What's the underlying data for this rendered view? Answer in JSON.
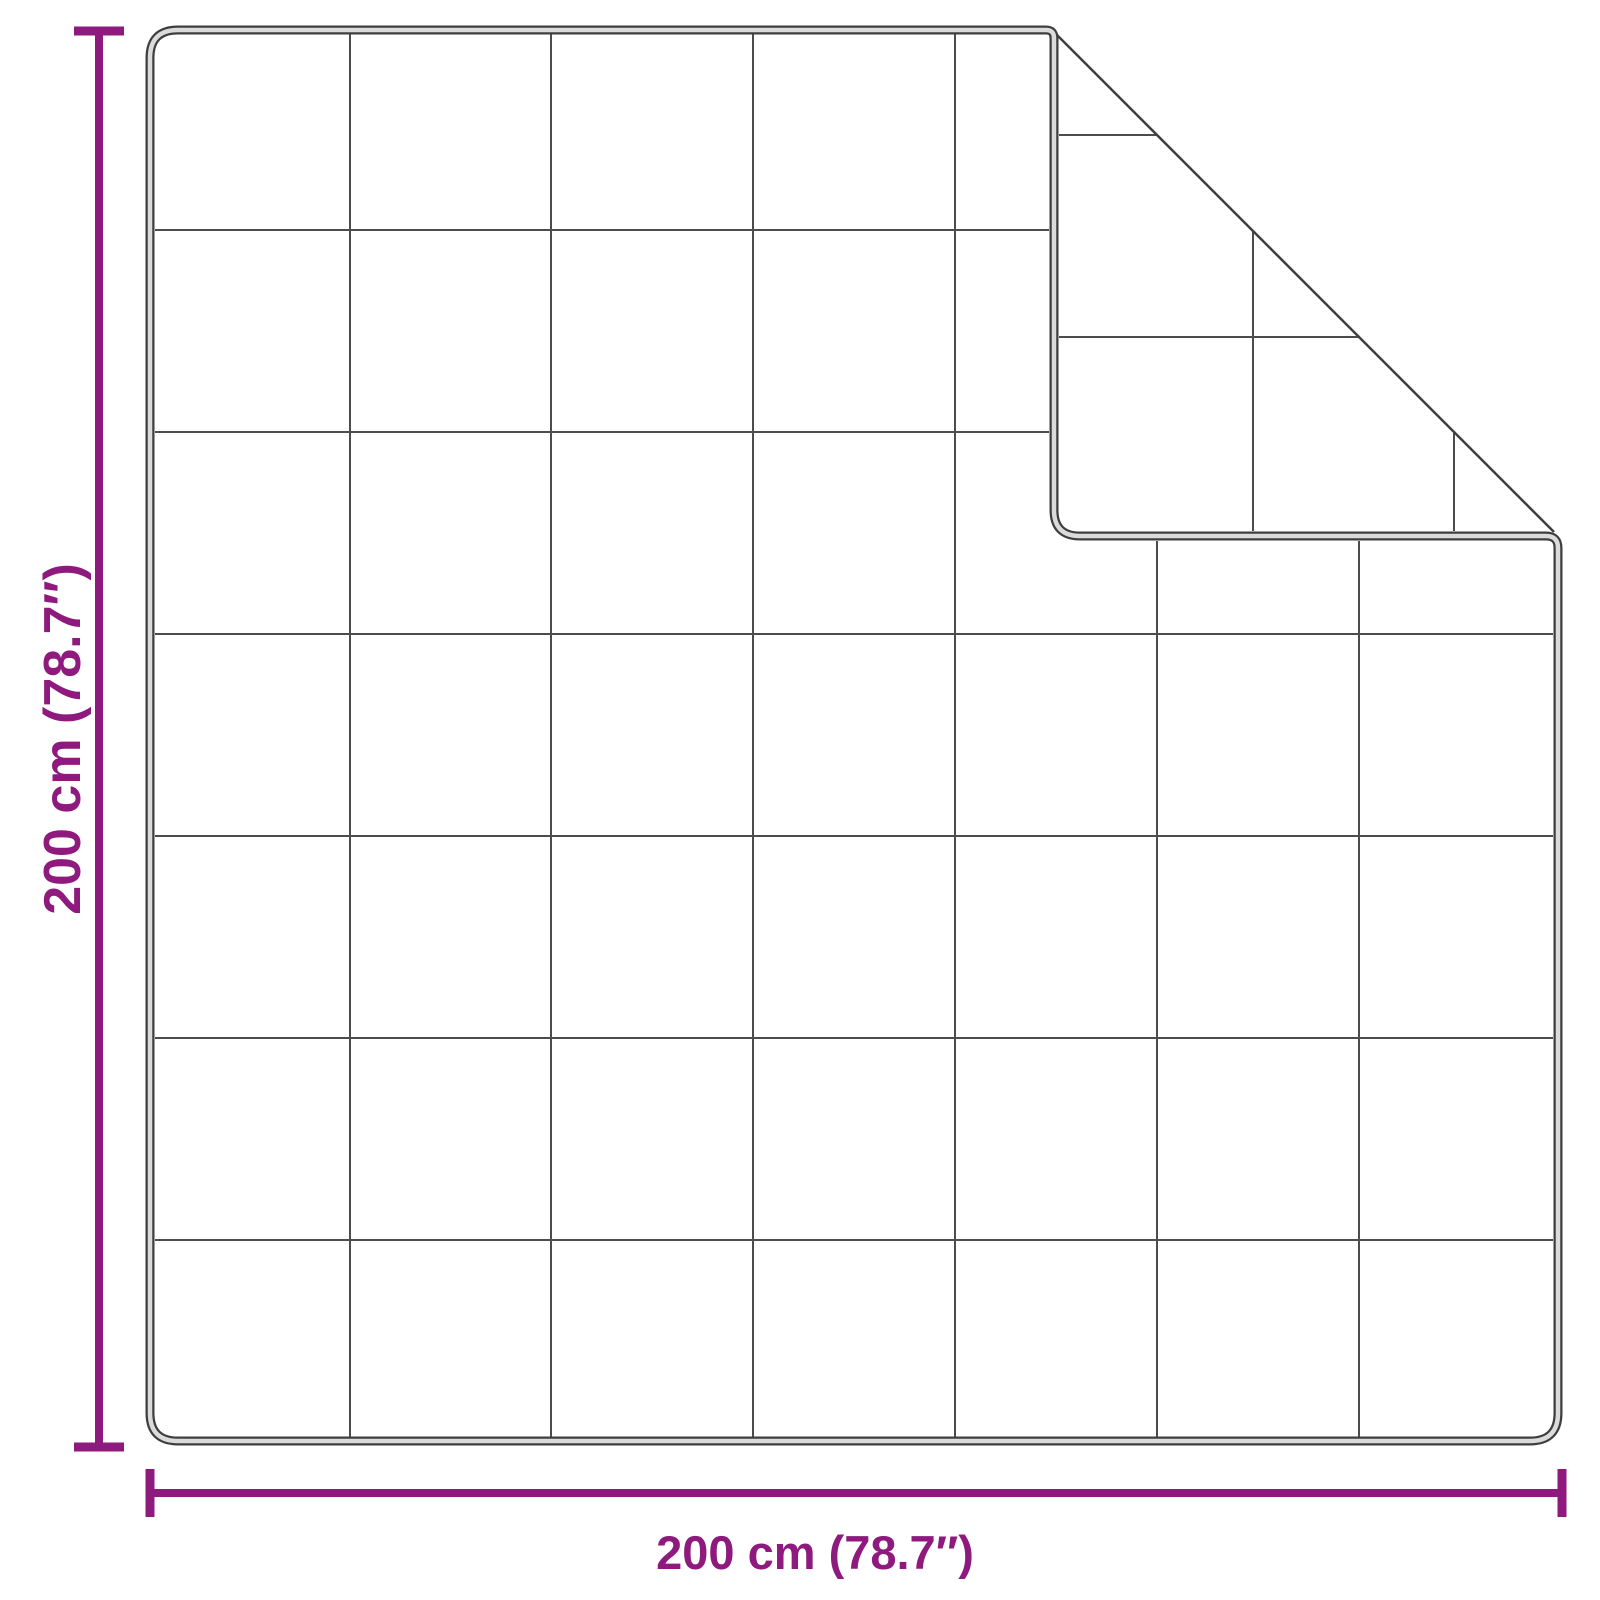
{
  "diagram": {
    "type": "product-dimension-diagram",
    "subject": "quilted blanket with top-right corner folded over",
    "grid": {
      "rows": 7,
      "columns": 7
    }
  },
  "dimensions": {
    "height_label": "200 cm (78.7″)",
    "width_label": "200 cm (78.7″)",
    "height_cm": 200,
    "width_cm": 200,
    "height_inches": 78.7,
    "width_inches": 78.7
  },
  "colors": {
    "dimension_accent": "#8E1A7E",
    "edge_dark": "#3E3E3E",
    "edge_highlight": "#DBDBDB",
    "grid_line": "#4C4C4C",
    "crease_line": "#3E3E3E",
    "background": "#FFFFFF"
  }
}
